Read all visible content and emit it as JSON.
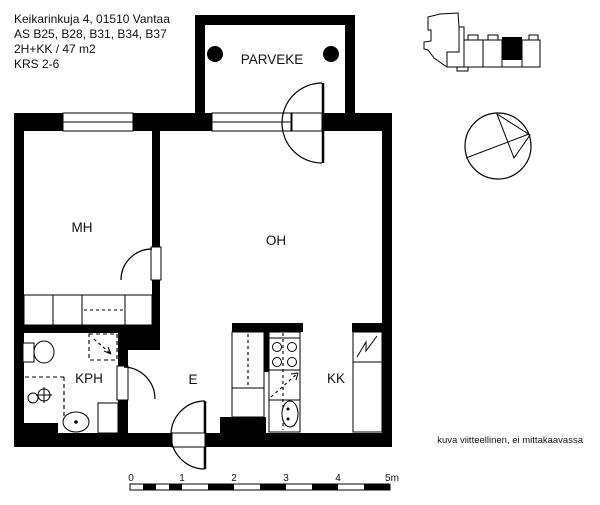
{
  "header": {
    "line1": "Keikarinkuja 4, 01510 Vantaa",
    "line2": "AS B25, B28, B31, B34, B37",
    "line3": "2H+KK / 47 m2",
    "line4": "KRS 2-6"
  },
  "rooms": {
    "balcony": "PARVEKE",
    "bedroom": "MH",
    "living_room": "OH",
    "bathroom": "KPH",
    "entry": "E",
    "kitchenette": "KK"
  },
  "scale_bar": {
    "labels": [
      "0",
      "1",
      "2",
      "3",
      "4",
      "5m"
    ]
  },
  "footnote": "kuva viitteellinen, ei mittakaavassa",
  "colors": {
    "wall": "#000000",
    "line": "#1a1a1a",
    "background": "#ffffff"
  }
}
